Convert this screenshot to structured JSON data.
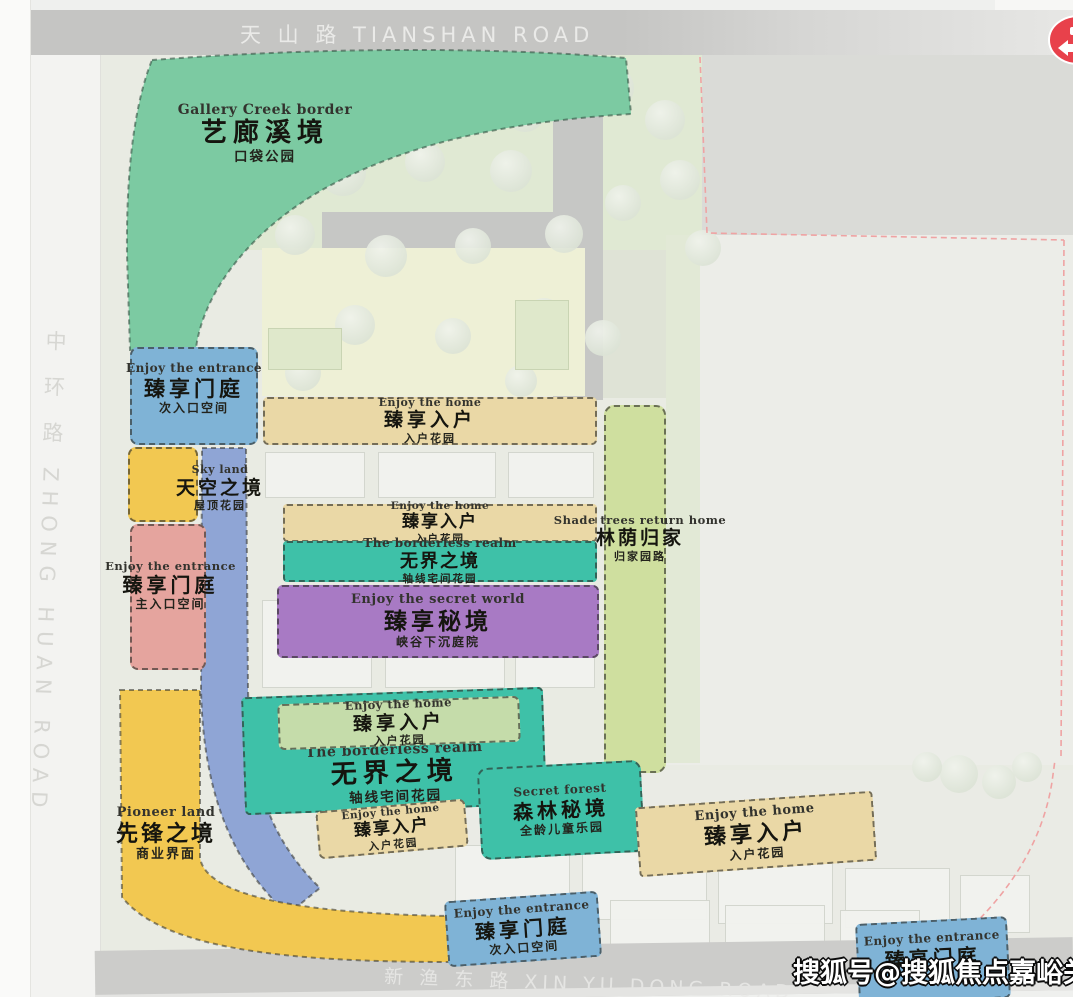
{
  "roads": {
    "top": "天 山 路 TIANSHAN ROAD",
    "left": "中 环 路 ZHONG HUAN ROAD",
    "bottom": "新 渔 东 路 XIN YU DONG ROAD"
  },
  "watermark": "搜狐号@搜狐焦点嘉峪关站",
  "zones": {
    "gallery_creek": {
      "en": "Gallery Creek border",
      "cn": "艺廊溪境",
      "sub": "口袋公园"
    },
    "entrance_left": {
      "en": "Enjoy the entrance",
      "cn": "臻享门庭",
      "sub": "次入口空间"
    },
    "home_top": {
      "en": "Enjoy the home",
      "cn": "臻享入户",
      "sub": "入户花园"
    },
    "sky_land": {
      "en": "Sky land",
      "cn": "天空之境",
      "sub": "屋顶花园"
    },
    "entrance_main": {
      "en": "Enjoy the entrance",
      "cn": "臻享门庭",
      "sub": "主入口空间"
    },
    "home_mid": {
      "en": "Enjoy the home",
      "cn": "臻享入户",
      "sub": "入户花园"
    },
    "borderless_mid": {
      "en": "The borderless realm",
      "cn": "无界之境",
      "sub": "轴线宅间花园"
    },
    "secret_world": {
      "en": "Enjoy the secret world",
      "cn": "臻享秘境",
      "sub": "峡谷下沉庭院"
    },
    "shade_trees": {
      "en": "Shade trees return home",
      "cn": "林荫归家",
      "sub": "归家园路"
    },
    "home_lower": {
      "en": "Enjoy the home",
      "cn": "臻享入户",
      "sub": "入户花园"
    },
    "borderless_lower": {
      "en": "The borderless realm",
      "cn": "无界之境",
      "sub": "轴线宅间花园"
    },
    "secret_forest": {
      "en": "Secret forest",
      "cn": "森林秘境",
      "sub": "全龄儿童乐园"
    },
    "home_small": {
      "en": "Enjoy the home",
      "cn": "臻享入户",
      "sub": "入户花园"
    },
    "home_right": {
      "en": "Enjoy the home",
      "cn": "臻享入户",
      "sub": "入户花园"
    },
    "entrance_bottom": {
      "en": "Enjoy the entrance",
      "cn": "臻享门庭",
      "sub": "次入口空间"
    },
    "entrance_bottom_right": {
      "en": "Enjoy the entrance",
      "cn": "臻享门庭"
    },
    "pioneer": {
      "en": "Pioneer land",
      "cn": "先锋之境",
      "sub": "商业界面"
    }
  },
  "colors": {
    "teal": "#3ec1a8",
    "purple": "#a87ac4",
    "blue": "#7fb3d6",
    "tan": "#ead8a6",
    "bright_yellow": "#f2c851",
    "pink": "#e5a49e",
    "mint_green": "#7ccaa2",
    "periwinkle": "#8fa5d5",
    "light_green": "#c5dcaa",
    "band_green": "#cfdf9f",
    "logo_red": "#e8414b",
    "road_gray": "#c6c6c4"
  }
}
